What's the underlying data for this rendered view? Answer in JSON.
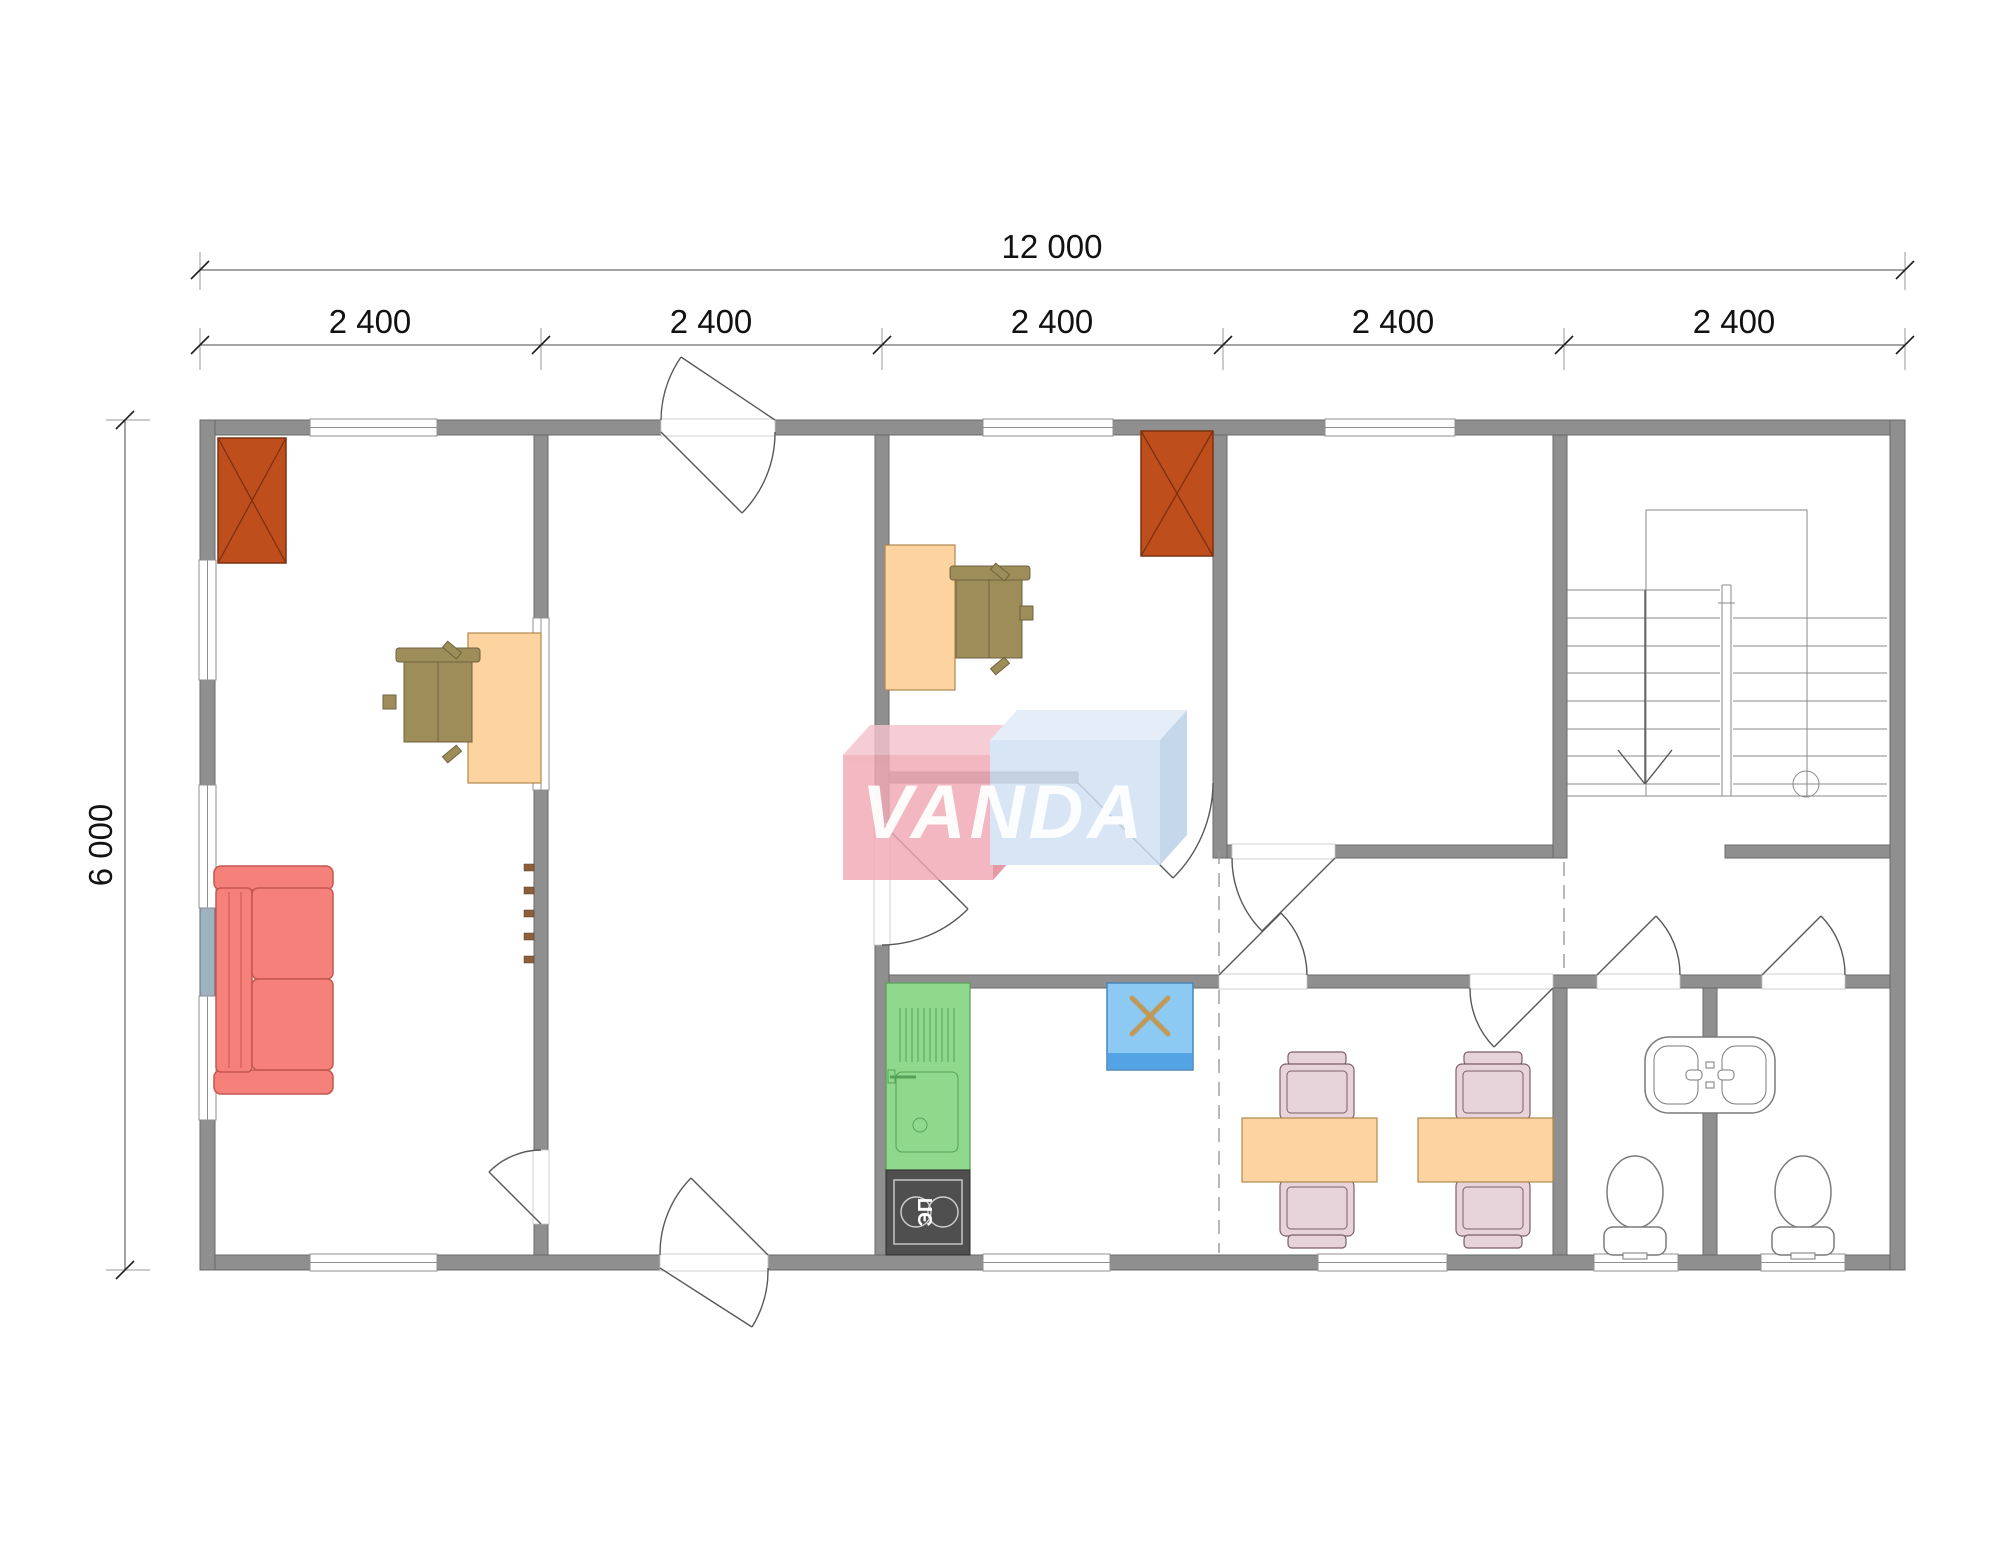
{
  "dimensions": {
    "overall_width": "12 000",
    "segments": [
      "2 400",
      "2 400",
      "2 400",
      "2 400",
      "2 400"
    ],
    "overall_height": "6 000"
  },
  "watermark": {
    "text": "VANDA"
  },
  "kitchen": {
    "stove_label": "ЭП"
  },
  "furniture": {
    "items": [
      "chimney",
      "desk",
      "office-chair",
      "coat-hooks",
      "sofa",
      "kitchen-counter-with-sink",
      "electric-stove",
      "refrigerator",
      "dining-table",
      "dining-chair",
      "wash-basin",
      "toilet",
      "staircase"
    ]
  },
  "colors": {
    "wall": "#8f8f8f",
    "wallStroke": "#6a6a6a",
    "chimney": "#bf4e1d",
    "desk": "#fdd3a0",
    "chair": "#9d8d58",
    "sofa": "#f5817a",
    "counter": "#90d98c",
    "stove": "#4f4f4f",
    "appliance": "#8ccaf4",
    "applianceStripe": "#54a3e4",
    "table": "#fdd3a0",
    "diningChair": "#e6d4da",
    "logoPink": "#f0a8b4",
    "logoPinkTop": "#f6c3cc",
    "logoPinkSide": "#e08694",
    "logoBlue": "#cfe0f2",
    "logoBlueTop": "#dfeaf7",
    "logoBlueSide": "#b9cfe7"
  }
}
